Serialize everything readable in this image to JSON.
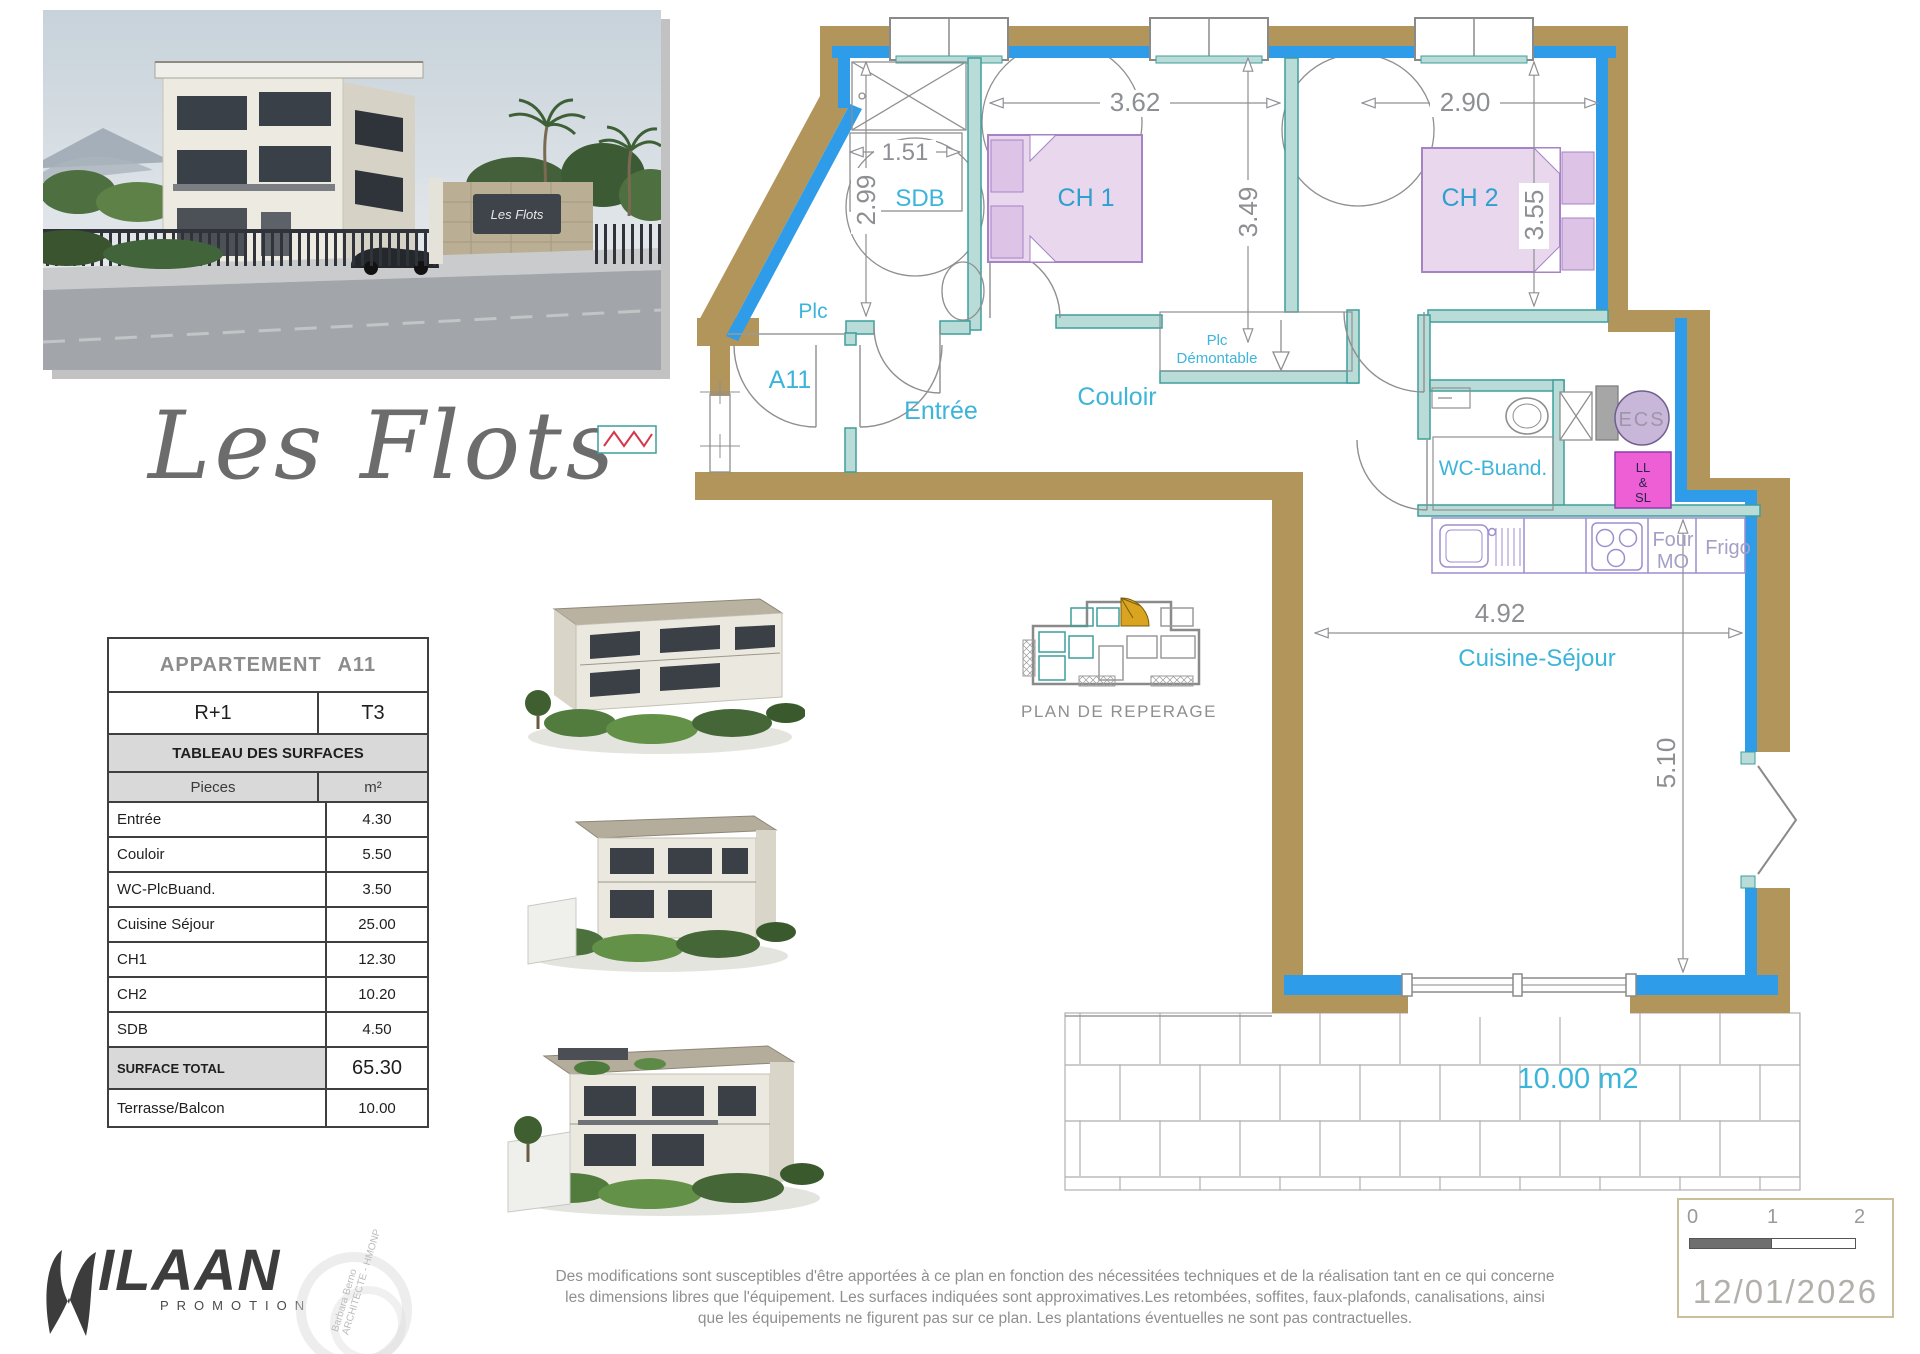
{
  "title": {
    "text": "Les Flots"
  },
  "photo": {
    "sign": "Les Flots"
  },
  "table": {
    "header": "APPARTEMENT A11",
    "floor": "R+1",
    "type": "T3",
    "section": "TABLEAU DES SURFACES",
    "col_pieces": "Pieces",
    "col_m2": "m²",
    "rows": [
      {
        "label": "Entrée",
        "value": "4.30"
      },
      {
        "label": "Couloir",
        "value": "5.50"
      },
      {
        "label": "WC-PlcBuand.",
        "value": "3.50"
      },
      {
        "label": "Cuisine Séjour",
        "value": "25.00"
      },
      {
        "label": "CH1",
        "value": "12.30"
      },
      {
        "label": "CH2",
        "value": "10.20"
      },
      {
        "label": "SDB",
        "value": "4.50"
      }
    ],
    "total_label": "SURFACE TOTAL",
    "total_value": "65.30",
    "terrace_label": "Terrasse/Balcon",
    "terrace_value": "10.00"
  },
  "plan": {
    "rooms": {
      "sdb": "SDB",
      "ch1": "CH 1",
      "ch2": "CH 2",
      "plc": "Plc",
      "unit": "A11",
      "entree": "Entrée",
      "couloir": "Couloir",
      "plc_demontable": [
        "Plc",
        "Démontable"
      ],
      "wc_buand": "WC-Buand.",
      "ecs": "ECS",
      "ll_sl": [
        "LL",
        "&",
        "SL"
      ],
      "four_mo": [
        "Four",
        "MO"
      ],
      "frigo": "Frigo",
      "cuisine": "Cuisine-Séjour"
    },
    "dims": {
      "sdb_w": "1.51",
      "sdb_h": "2.99",
      "ch1_w": "3.62",
      "ch1_h": "3.49",
      "ch2_w": "2.90",
      "ch2_h": "3.55",
      "sejour_w": "4.92",
      "sejour_h": "5.10"
    },
    "terrace_area": "10.00 m2",
    "key_plan_caption": "PLAN DE REPERAGE"
  },
  "footer": {
    "logo_text": "ILAAN",
    "logo_sub": "PROMOTION",
    "stamp": [
      "Barbara Berno",
      "ARCHITECTE - HMONP"
    ],
    "disclaimer": [
      "Des modifications sont susceptibles d'être apportées à ce plan en fonction des nécessitées techniques et de la réalisation tant en ce qui concerne",
      "les dimensions libres que l'équipement.  Les surfaces indiquées sont approximatives.Les retombées, soffites, faux-plafonds, canalisations, ainsi",
      "que les équipements ne figurent pas sur ce plan. Les plantations éventuelles ne sont pas contractuelles."
    ],
    "scale_ticks": [
      "0",
      "1",
      "2"
    ],
    "date": "12/01/2026"
  },
  "colors": {
    "wall_tan": "#b2955a",
    "wall_blue": "#2e9ce8",
    "partition_teal": "#b9dcd8",
    "label_cyan": "#3db4da",
    "accent_pink": "#ee5ed4",
    "accent_lavender": "#c9b7da"
  }
}
